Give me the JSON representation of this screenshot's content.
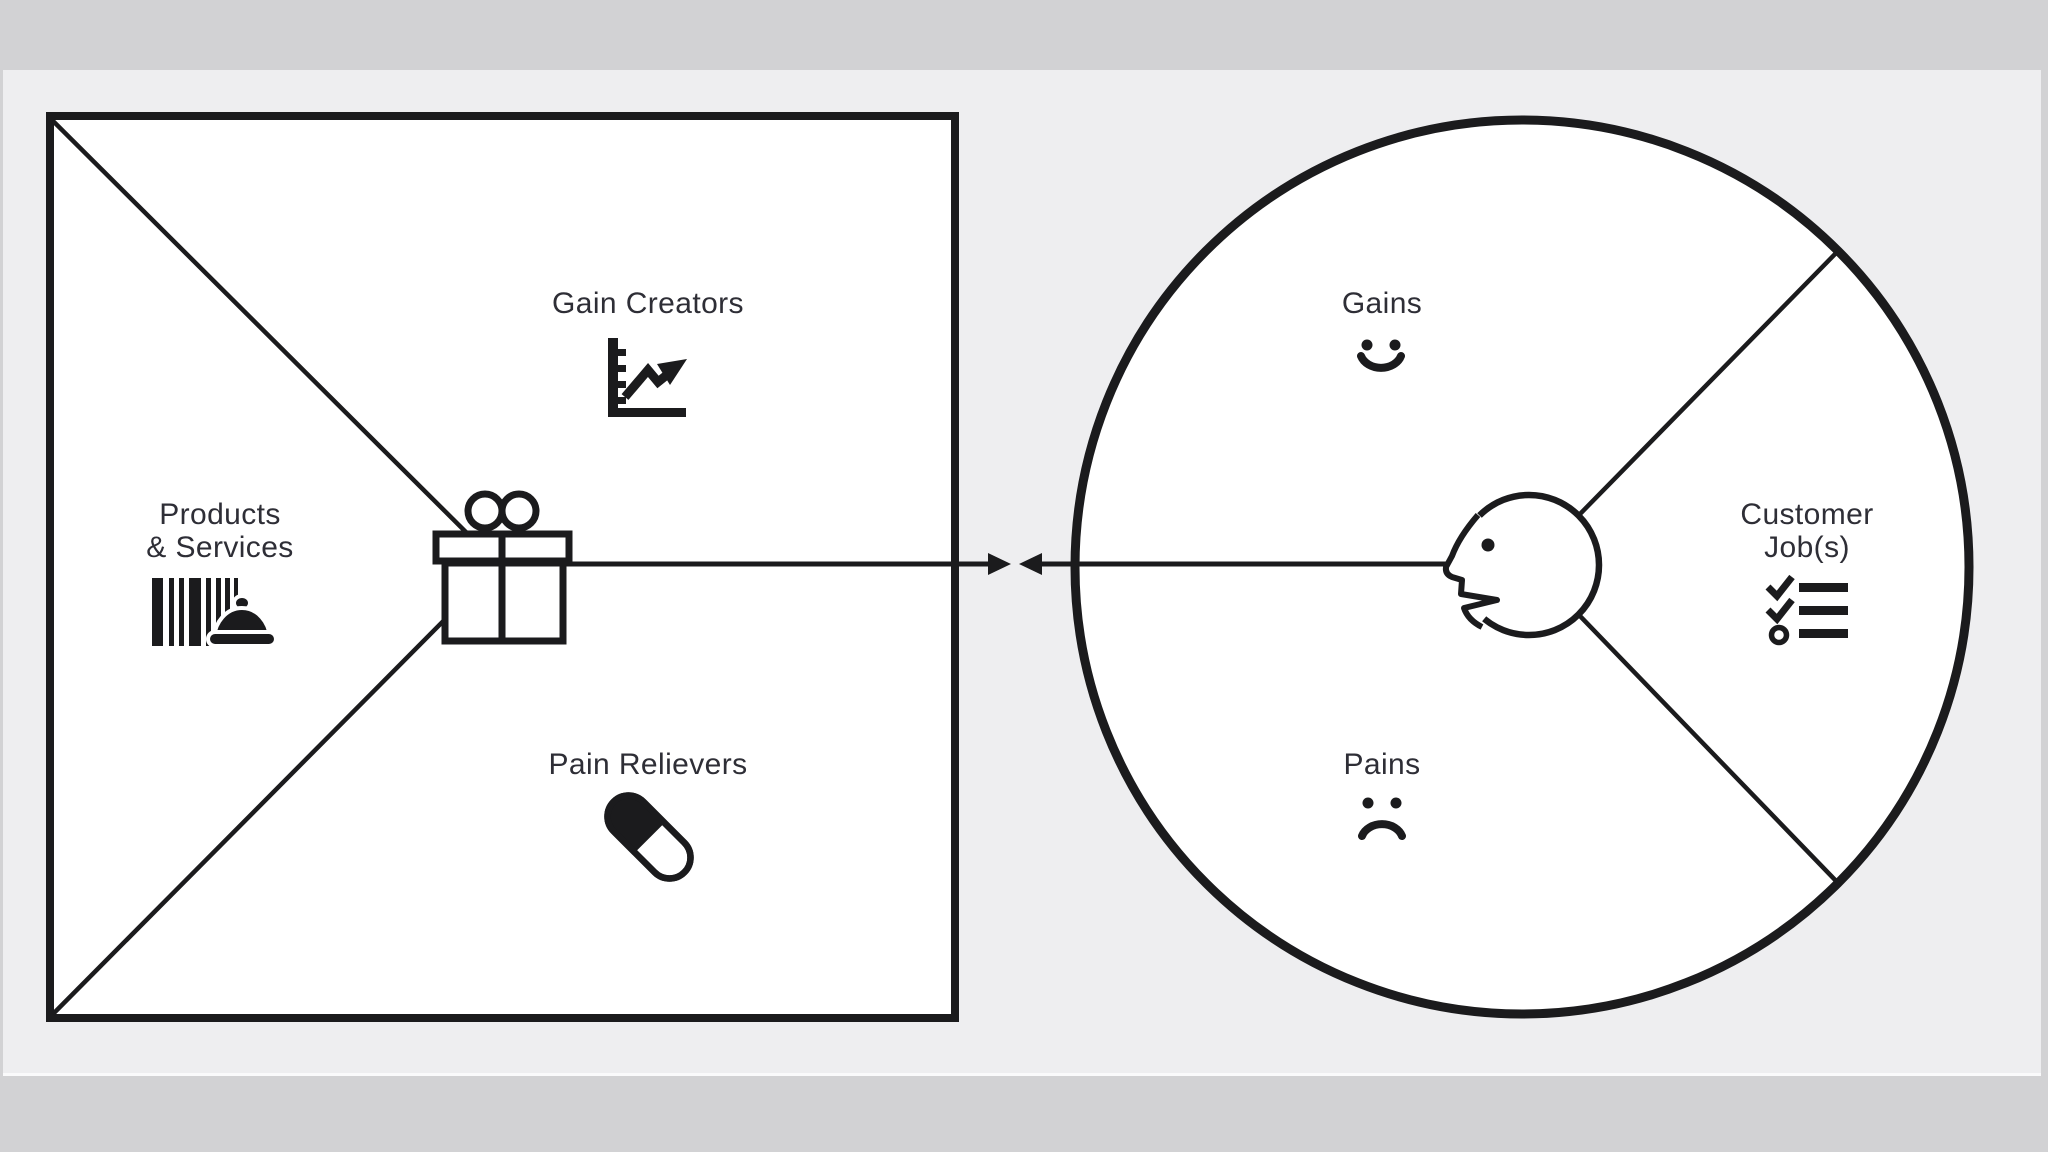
{
  "colors": {
    "outer_background": "#d2d2d4",
    "panel_background": "#eeeef0",
    "shape_fill": "#ffffff",
    "ink": "#1b1b1d",
    "text": "#2e2e36"
  },
  "value_map_square": {
    "gain_creators": {
      "label": "Gain Creators",
      "icon": "line-chart-icon"
    },
    "products_services": {
      "label": "Products\n& Services",
      "icon": "barcode-serving-dish-icon"
    },
    "pain_relievers": {
      "label": "Pain Relievers",
      "icon": "pill-icon"
    },
    "center_icon": "gift-icon"
  },
  "customer_profile_circle": {
    "gains": {
      "label": "Gains",
      "icon": "smiley-face-icon"
    },
    "customer_jobs": {
      "label": "Customer\nJob(s)",
      "icon": "checklist-icon"
    },
    "pains": {
      "label": "Pains",
      "icon": "sad-face-icon"
    },
    "center_icon": "head-profile-icon"
  },
  "connector": {
    "icon": "double-headed-arrow-icon"
  }
}
